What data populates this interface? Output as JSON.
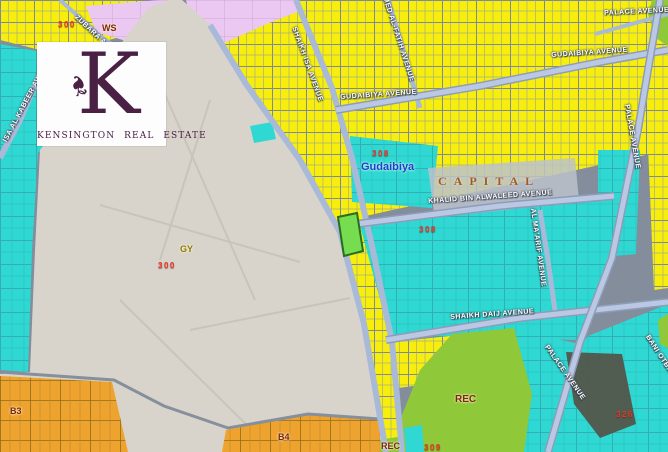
{
  "logo": {
    "letter": "K",
    "name": "KENSINGTON REAL ESTATE"
  },
  "map": {
    "street_labels": [
      {
        "text": "ZUBARA AVE"
      },
      {
        "text": "ISA AL KABEER AVE"
      },
      {
        "text": "SHAIKH ISA AVENUE"
      },
      {
        "text": "MED AL-FATIH AVENUE"
      },
      {
        "text": "GUDAIBIYA AVENUE"
      },
      {
        "text": "PALACE AVENUE"
      },
      {
        "text": "GUDAIBIYA AVENUE"
      },
      {
        "text": "KHALID BIN ALWALEED AVENUE"
      },
      {
        "text": "AL MA'ARIF AVENUE"
      },
      {
        "text": "PALACE AVENUE"
      },
      {
        "text": "SHAIKH DAIJ AVENUE"
      },
      {
        "text": "PALACE AVENUE"
      },
      {
        "text": "BANI OTBAH AVENUE"
      }
    ],
    "area_labels": [
      {
        "text": "WS"
      },
      {
        "text": "GY"
      },
      {
        "text": "CAPITAL"
      },
      {
        "text": "Gudaibiya"
      },
      {
        "text": "B3"
      },
      {
        "text": "B4"
      },
      {
        "text": "REC"
      },
      {
        "text": "REC"
      }
    ],
    "block_numbers": [
      "300",
      "300",
      "308",
      "308",
      "326",
      "309"
    ]
  },
  "colors": {
    "base": "#848d9c",
    "road": "#a9bad9",
    "road_core": "#bac8e4",
    "road_edge": "#8d9db9",
    "road_minor": "#99a4b8",
    "parcel_yellow": "#f7ee0e",
    "parcel_cyan": "#2fd8d2",
    "parcel_orange": "#efa32f",
    "lavender": "#ebc8f1",
    "graveyard": "#d8d4cb",
    "graveyard_path": "#c7c3b9",
    "rec_green": "#8fc838",
    "highlight_green": "#76dc50",
    "highlight_border": "#276e1d",
    "trees_dark": "#53564a",
    "capital_gray": "#bcc2cb",
    "logo_purple": "#4a2045",
    "number_red": "#e8372b",
    "label_maroon": "#7d2413",
    "label_olive": "#8a7616",
    "label_capital": "#a35a22",
    "label_city": "#1d41c8"
  }
}
